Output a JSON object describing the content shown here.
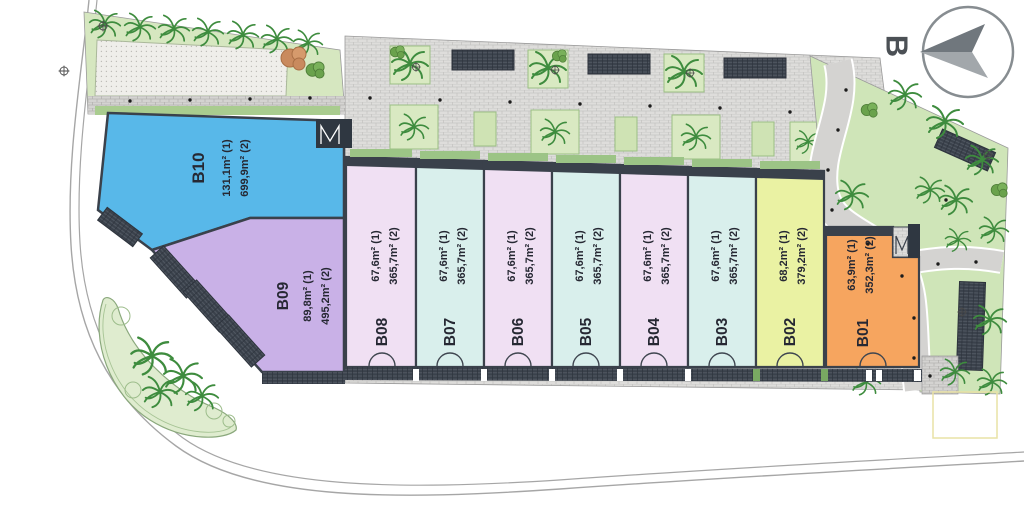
{
  "plan_title": "site-master-plan",
  "compass": {
    "label": "B"
  },
  "units": [
    {
      "id": "B01",
      "area1": "63,9m² (1)",
      "area2": "352,3m² (2)",
      "color": "#f6a55f"
    },
    {
      "id": "B02",
      "area1": "68,2m² (1)",
      "area2": "379,2m² (2)",
      "color": "#eaf2a3"
    },
    {
      "id": "B03",
      "area1": "67,6m² (1)",
      "area2": "365,7m² (2)",
      "color": "#d9efec"
    },
    {
      "id": "B04",
      "area1": "67,6m² (1)",
      "area2": "365,7m² (2)",
      "color": "#f0e0f3"
    },
    {
      "id": "B05",
      "area1": "67,6m² (1)",
      "area2": "365,7m² (2)",
      "color": "#d9efec"
    },
    {
      "id": "B06",
      "area1": "67,6m² (1)",
      "area2": "365,7m² (2)",
      "color": "#f0e0f3"
    },
    {
      "id": "B07",
      "area1": "67,6m² (1)",
      "area2": "365,7m² (2)",
      "color": "#d9efec"
    },
    {
      "id": "B08",
      "area1": "67,6m² (1)",
      "area2": "365,7m² (2)",
      "color": "#f0e0f3"
    },
    {
      "id": "B09",
      "area1": "89,8m² (1)",
      "area2": "495,2m² (2)",
      "color": "#c9b1e7"
    },
    {
      "id": "B10",
      "area1": "131,1m² (1)",
      "area2": "699,9m² (2)",
      "color": "#58b8e9"
    }
  ],
  "colors": {
    "structure_dark": "#3a414b",
    "paving": "#dedddb",
    "lawn": "#d6e7c0",
    "tree": "#4e9140",
    "road_line": "#a6a6a6"
  }
}
